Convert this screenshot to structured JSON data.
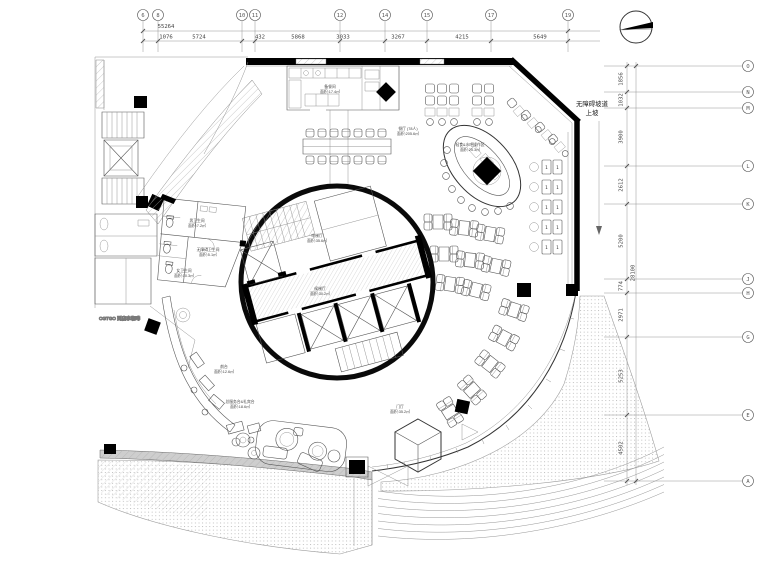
{
  "drawing": {
    "grid_top": {
      "total": "55264",
      "bubbles": [
        "6",
        "8",
        "10",
        "11",
        "12",
        "14",
        "15",
        "17",
        "19"
      ],
      "dims": [
        "1076",
        "5724",
        "432",
        "5868",
        "3033",
        "3267",
        "4215",
        "5649"
      ]
    },
    "grid_right": {
      "total": "28100",
      "bubbles": [
        "O",
        "N",
        "M",
        "L",
        "K",
        "J",
        "H",
        "G",
        "E",
        "A"
      ],
      "dims": [
        "1856",
        "1032",
        "3900",
        "2612",
        "5200",
        "774",
        "2971",
        "5253",
        "4502"
      ]
    },
    "ramp": {
      "line1": "无障碍坡道",
      "line2": "上坡"
    },
    "rooms": {
      "kitchen": {
        "name": "备餐间",
        "area": "面积:17.4㎡"
      },
      "dining": {
        "name": "餐厅 (78人)",
        "area": "面积:205.6㎡"
      },
      "bar": {
        "name": "轻食&水吧操作区",
        "area": "面积:25.3㎡"
      },
      "lift_upper": {
        "name": "电梯厅",
        "area": "面积:35.6㎡"
      },
      "lift_lower": {
        "name": "候梯厅",
        "area": "面积:30.2㎡"
      },
      "wc_male": {
        "name": "男卫生间",
        "area": "面积:7.2㎡"
      },
      "wc_access": {
        "name": "无障碍卫生间",
        "area": "面积:5.1㎡"
      },
      "wc_female": {
        "name": "女卫生间",
        "area": "面积:10.3㎡"
      },
      "reception": {
        "name": "前台",
        "area": "面积:12.6㎡"
      },
      "concierge": {
        "name": "总服务台&礼宾台",
        "area": "面积:18.6㎡"
      },
      "foyer": {
        "name": "门厅",
        "area": "面积:35.2㎡"
      }
    },
    "togo_label": "CGTGO 到店拿咖啡",
    "seat_no": "1",
    "colors": {
      "line": "#444",
      "wall": "#000",
      "hatch": "#999"
    }
  }
}
